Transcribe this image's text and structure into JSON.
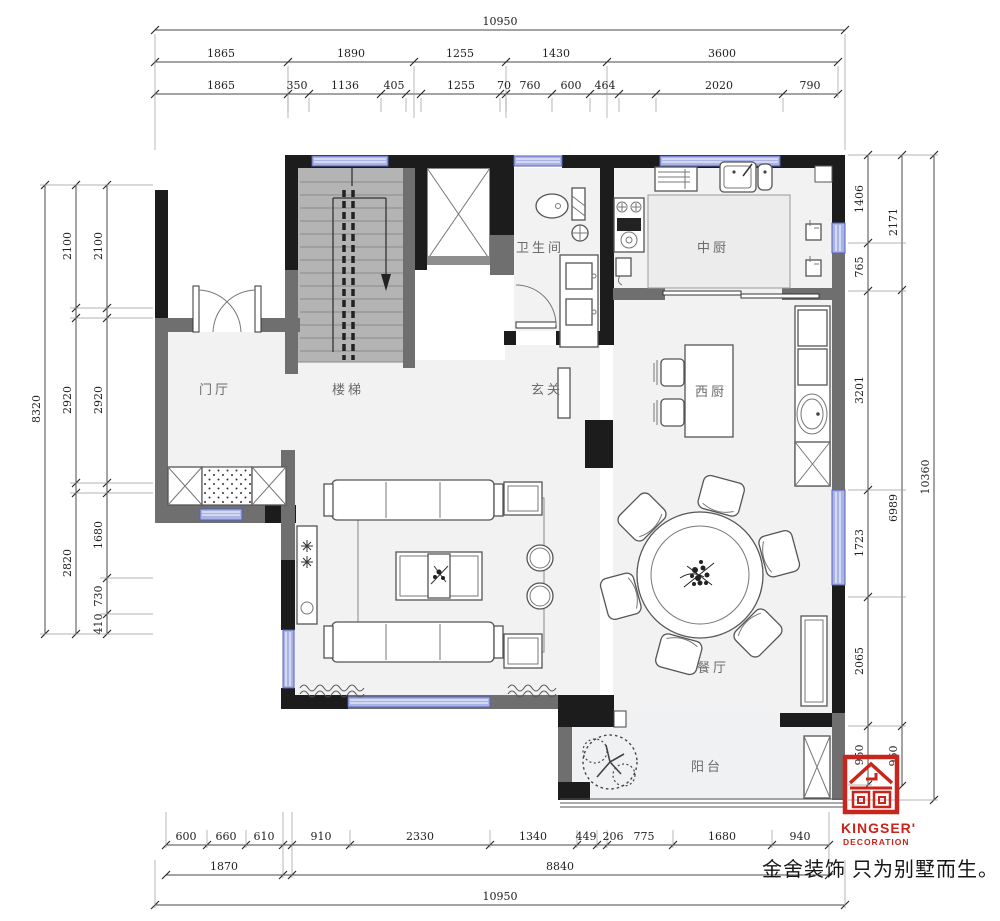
{
  "rooms": {
    "entry": "门厅",
    "stairs": "楼梯",
    "bathroom": "卫生间",
    "foyer": "玄关",
    "chinese_kitchen": "中厨",
    "western_kitchen": "西厨",
    "dining": "餐厅",
    "balcony": "阳台"
  },
  "dims": {
    "top": {
      "total": "10950",
      "row2": [
        "1865",
        "1890",
        "1255",
        "1430",
        "3600"
      ],
      "row3": [
        "1865",
        "350",
        "1136",
        "405",
        "1255",
        "70",
        "760",
        "600",
        "464",
        "2020",
        "790"
      ]
    },
    "bottom": {
      "row1": [
        "600",
        "660",
        "610",
        "910",
        "2330",
        "1340",
        "449",
        "206",
        "775",
        "1680",
        "940"
      ],
      "row2": [
        "1870",
        "8840"
      ],
      "total": "10950"
    },
    "left": {
      "outer": "8320",
      "middle": [
        "2100",
        "2920",
        "2820"
      ],
      "inner": [
        "2100",
        "2920",
        "1680",
        "730",
        "410"
      ]
    },
    "right": {
      "inner": [
        "1406",
        "765",
        "3201",
        "1723",
        "2065",
        "950"
      ],
      "middle": [
        "2171",
        "6989",
        "960"
      ],
      "outer": "10360"
    }
  },
  "logo": {
    "brand": "KINGSER'",
    "subtitle": "DECORATION",
    "tagline": "金舍装饰 只为别墅而生。"
  },
  "colors": {
    "wall_black": "#1c1c1c",
    "wall_gray": "#6f6f6f",
    "stair_floor": "#b4b4b4",
    "floor": "#f2f2f3",
    "window_fill": "#a9b3e6",
    "window_border": "#5560b8",
    "dim_line": "#4a4a4a",
    "logo_red": "#c9251c"
  }
}
